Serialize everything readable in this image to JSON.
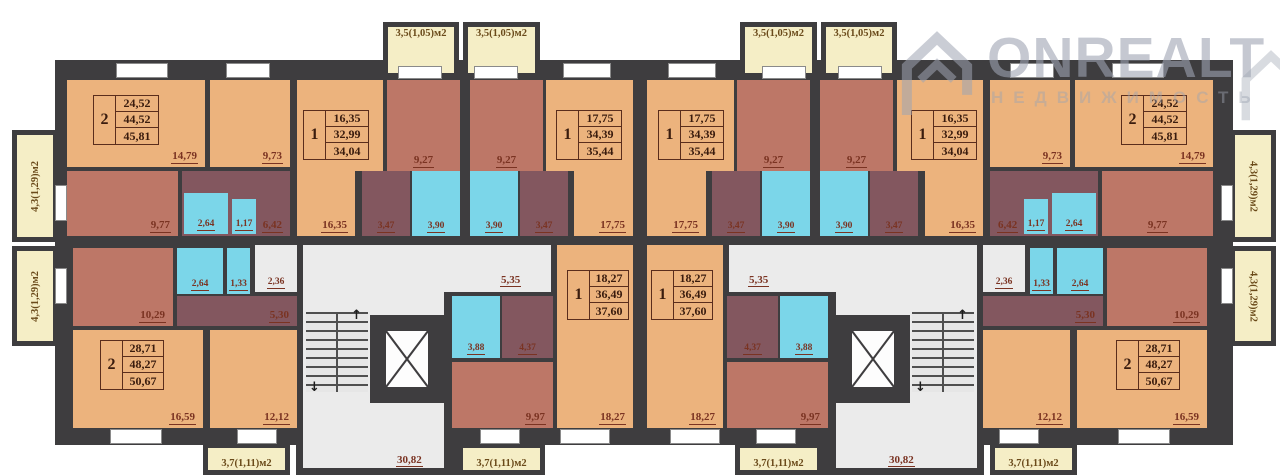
{
  "watermark": {
    "brand": "ONREALT",
    "subtitle": "НЕДВИЖИМОСТЬ"
  },
  "icons": {
    "arrow_up": "↑",
    "arrow_down": "↓"
  },
  "colors": {
    "wall": "#3e3d3f",
    "room_tan": "#ecb37d",
    "room_red": "#bd7767",
    "room_maroon": "#83575f",
    "room_cyan": "#7bd6e9",
    "balcony_cream": "#f5eec6",
    "corridor_gray": "#ebebeb",
    "label_text": "#7a3322"
  },
  "balconies": {
    "top": "3,5(1,05)м2",
    "side": "4,3(1,29)м2",
    "bottom": "3,7(1,11)м2"
  },
  "common": {
    "corridor": "5,35",
    "entry": "2,36",
    "lobby": "30,82"
  },
  "apartments": {
    "two_room_top": {
      "type": "2",
      "areas": [
        "24,52",
        "44,52",
        "45,81"
      ],
      "rooms": {
        "living": "14,79",
        "bedroom": "9,73",
        "kitchen": "9,77",
        "hall": "6,42",
        "bath": "2,64",
        "wc": "1,17"
      }
    },
    "one_room_a": {
      "type": "1",
      "areas": [
        "16,35",
        "32,99",
        "34,04"
      ],
      "rooms": {
        "living": "16,35",
        "kitchen": "9,27",
        "hall": "3,47",
        "bath": "3,90"
      }
    },
    "one_room_b": {
      "type": "1",
      "areas": [
        "17,75",
        "34,39",
        "35,44"
      ],
      "rooms": {
        "living": "17,75",
        "kitchen": "9,27",
        "hall": "3,47",
        "bath": "3,90"
      }
    },
    "one_room_c": {
      "type": "1",
      "areas": [
        "18,27",
        "36,49",
        "37,60"
      ],
      "rooms": {
        "living": "18,27",
        "kitchen": "9,97",
        "hall": "4,37",
        "bath": "3,88"
      }
    },
    "two_room_bottom": {
      "type": "2",
      "areas": [
        "28,71",
        "48,27",
        "50,67"
      ],
      "rooms": {
        "living": "16,59",
        "bedroom": "12,12",
        "kitchen": "10,29",
        "hall": "5,30",
        "bath": "2,64",
        "wc": "1,33"
      }
    }
  }
}
